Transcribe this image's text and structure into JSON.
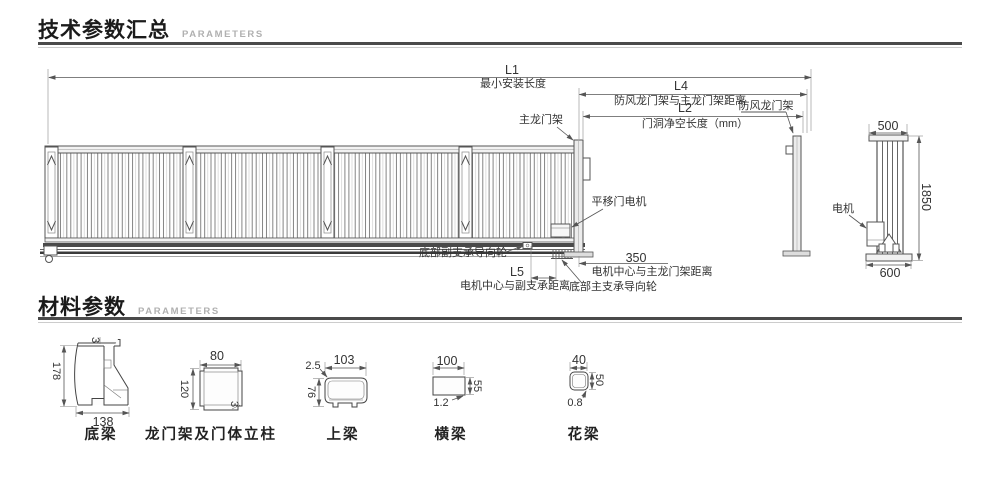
{
  "sections": {
    "tech": {
      "title": "技术参数汇总",
      "subtitle": "PARAMETERS"
    },
    "material": {
      "title": "材料参数",
      "subtitle": "PARAMETERS"
    }
  },
  "drawing": {
    "l1": "L1",
    "l1_label": "最小安装长度",
    "l4": "L4",
    "l4_label": "防风龙门架与主龙门架距离",
    "l2": "L2",
    "l2_label": "门洞净空长度（mm）",
    "l5": "L5",
    "l5_label": "电机中心与副支承距离",
    "d350": "350",
    "d350_label": "电机中心与主龙门架距离",
    "main_gantry": "主龙门架",
    "wind_gantry": "防风龙门架",
    "motor": "平移门电机",
    "aux_wheel": "底部副支承导向轮",
    "main_wheel": "底部主支承导向轮",
    "side_motor": "电机",
    "side_width": "500",
    "side_height": "1850",
    "side_base": "600"
  },
  "materials": [
    {
      "name": "底梁",
      "width": "138",
      "height": "178",
      "thickness": "3"
    },
    {
      "name": "龙门架及门体立柱",
      "width": "80",
      "height": "120",
      "thickness": "3"
    },
    {
      "name": "上梁",
      "width": "103",
      "height": "76",
      "thickness": "2.5"
    },
    {
      "name": "横梁",
      "width": "100",
      "height": "55",
      "thickness": "1.2"
    },
    {
      "name": "花梁",
      "width": "40",
      "height": "50",
      "thickness": "0.8"
    }
  ],
  "colors": {
    "line": "#555555",
    "dim": "#8a8a8a",
    "text": "#333333",
    "title": "#1b1b1b",
    "subtitle": "#b0b0b0",
    "rule_dark": "#4a4a4a",
    "rule_light": "#cccccc"
  }
}
